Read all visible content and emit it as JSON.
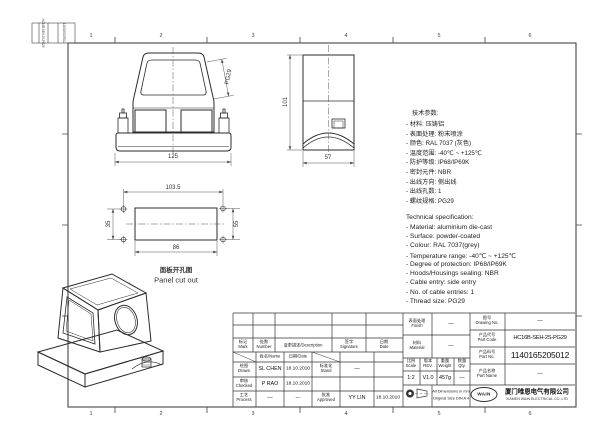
{
  "frame": {
    "columns": [
      "1",
      "2",
      "3",
      "4",
      "5",
      "6"
    ]
  },
  "corner_strip": {
    "text1": "HC16B-SEH-2S-PG29",
    "text2": "1140165205012"
  },
  "views": {
    "front": {
      "dim_width": "125",
      "thread": "PG29"
    },
    "side": {
      "dim_height": "101",
      "dim_width": "57"
    },
    "panel": {
      "dim_top": "103.5",
      "dim_bottom": "86",
      "dim_left": "35",
      "dim_right": "55",
      "caption_cn": "面板开孔图",
      "caption_en": "Panel cut out"
    }
  },
  "specs_cn": {
    "title": "技术参数:",
    "items": [
      "- 材料: 压铸铝",
      "- 表面处理: 粉末喷涂",
      "- 颜色: RAL 7037 (灰色)",
      "- 温度范围: -40℃ ~ +125℃",
      "- 防护等级: IP68/IP69K",
      "- 密封元件: NBR",
      "- 出线方向: 侧出线",
      "- 出线孔数: 1",
      "- 螺纹规格: PG29"
    ]
  },
  "specs_en": {
    "title": "Technical specification:",
    "items": [
      "- Material: aluminium die-cast",
      "- Surface: powder-coated",
      "- Colour: RAL 7037(grey)",
      "- Temperature range: -40℃ ~ +125℃",
      "- Degree of protection: IP68/IP69K",
      "- Hoods/Housings sealing: NBR",
      "- Cable entry: side entry",
      "- No. of cable entries: 1",
      "- Thread size: PG29"
    ]
  },
  "title_block": {
    "rev": {
      "mark": "标记\nMark",
      "number": "处数\nNumber",
      "description": "变更描述/Description",
      "signature": "签字\nSignature",
      "date": "日期\nDate"
    },
    "sub": {
      "name": "姓名/Name",
      "date": "日期/Date"
    },
    "rows": {
      "drawn_label": "绘图\nDrawn",
      "drawn_name": "SL CHEN",
      "drawn_date": "18.10.2010",
      "checked_label": "审核\nChecked",
      "checked_name": "P RAO",
      "checked_date": "18.10.2010",
      "process_label": "工艺\nProcess",
      "process_name": "—",
      "process_date": "—",
      "stand_label": "标准化\nStand",
      "stand_sig": "—",
      "approved_label": "批准\nApproved",
      "approved_name": "YY LIN",
      "approved_date": "18.10.2010"
    },
    "info": {
      "finish_label": "表面处理\nFinish",
      "finish_value": "—",
      "material_label": "材料\nMaterial",
      "material_value": "—",
      "drawing_no_label": "图号\nDrawing No.",
      "drawing_no_value": "—",
      "part_code_label": "产品代号\nPart Code",
      "part_code_value": "HC16B-SEH-2S-PG29",
      "part_no_label": "产品料号\nPart No.",
      "part_no_value": "1140165205012",
      "part_name_label": "产品名称\nPart Name",
      "part_name_value": "—",
      "scale_label": "比例\nScale",
      "scale_value": "1:2",
      "rev_label": "版本\nREV.",
      "rev_value": "V1.0",
      "weight_label": "重量\nWeight",
      "weight_value": "457g",
      "qty_label": "数量\nQty.",
      "qty_value": "—",
      "note_line1": "All Dimensions in mm",
      "note_line2": "Original Size DIN A 4",
      "logo": "WAIN",
      "company_cn": "厦门唯恩电气有限公司",
      "company_en": "XIAMEN WAIN ELECTRICAL CO.,LTD"
    }
  }
}
